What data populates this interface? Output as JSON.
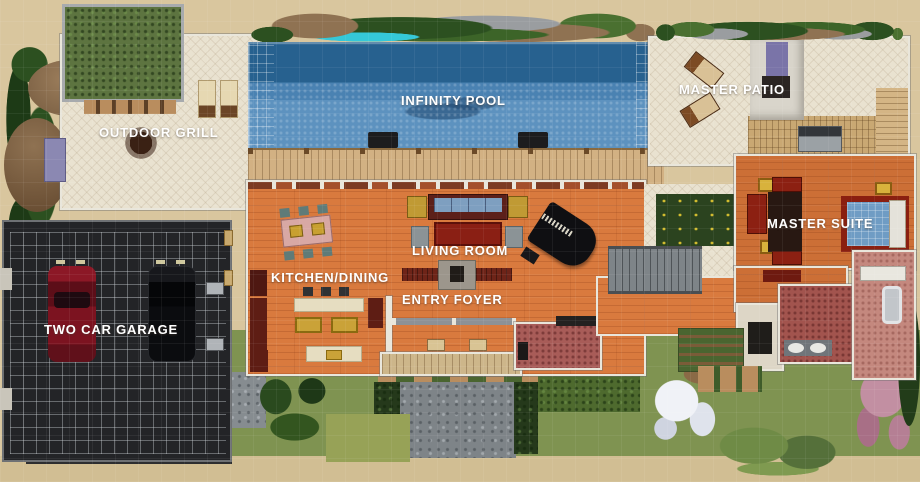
{
  "scene": {
    "description": "Top-down build-mode overview of a modern beach house lot",
    "room_labels": [
      {
        "id": "outdoor_grill",
        "text": "OUTDOOR GRILL"
      },
      {
        "id": "infinity_pool",
        "text": "INFINITY POOL"
      },
      {
        "id": "master_patio",
        "text": "MASTER PATIO"
      },
      {
        "id": "master_suite",
        "text": "MASTER SUITE"
      },
      {
        "id": "living_room",
        "text": "LIVING ROOM"
      },
      {
        "id": "kitchen_dining",
        "text": "KITCHEN/DINING"
      },
      {
        "id": "entry_foyer",
        "text": "ENTRY FOYER"
      },
      {
        "id": "two_car_garage",
        "text": "TWO CAR GARAGE"
      }
    ],
    "palette": {
      "sand": "#d9c69e",
      "pool_deep": "#27618f",
      "pool_shallow": "#5d92bf",
      "patio_tile": "#e9e2d0",
      "hardwood_orange": "#d97a3e",
      "deck_wood": "#d2b183",
      "garage_floor": "#232427",
      "grass": "#7f9351",
      "hedge": "#2b431f",
      "counter_maroon": "#5e1d14",
      "bath_red": "#a2544e",
      "bath_salmon": "#c4887e",
      "label_text": "#ffffff"
    }
  }
}
